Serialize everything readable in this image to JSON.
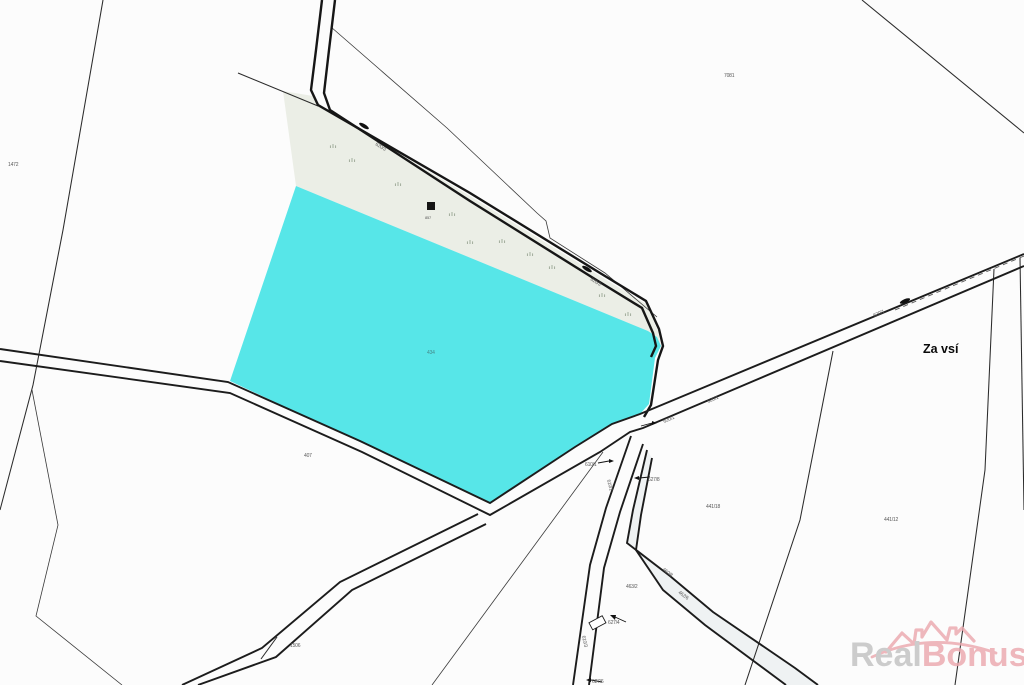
{
  "map": {
    "area_label": "Za vsí",
    "highlighted_parcel_number": "434",
    "building_number": "857",
    "colors": {
      "background": "#fcfcfc",
      "line": "#222222",
      "highlight": "#57E6E8",
      "strip": "#EBEEE6",
      "road_fill": "#EFF2F3",
      "label": "#5a5a5a",
      "grass": "#9AA694",
      "area_label_color": "#0a0a0a"
    },
    "labels": [
      {
        "text": "1472",
        "x": 8,
        "y": 166
      },
      {
        "text": "7081",
        "x": 724,
        "y": 77
      },
      {
        "text": "857",
        "x": 425,
        "y": 219,
        "size": 4
      },
      {
        "text": "434",
        "x": 427,
        "y": 354,
        "color": "#45888a"
      },
      {
        "text": "407",
        "x": 304,
        "y": 457
      },
      {
        "text": "620/3",
        "x": 375,
        "y": 145,
        "rot": 31
      },
      {
        "text": "620/3",
        "x": 590,
        "y": 280,
        "rot": 31
      },
      {
        "text": "620/1",
        "x": 664,
        "y": 423,
        "rot": -23
      },
      {
        "text": "620/1",
        "x": 708,
        "y": 403,
        "rot": -23
      },
      {
        "text": "620/1",
        "x": 874,
        "y": 317,
        "rot": -23
      },
      {
        "text": "610/1",
        "x": 585,
        "y": 466
      },
      {
        "text": "610/2",
        "x": 607,
        "y": 480,
        "rot": 75
      },
      {
        "text": "627/8",
        "x": 648,
        "y": 481
      },
      {
        "text": "441/18",
        "x": 706,
        "y": 508
      },
      {
        "text": "441/12",
        "x": 884,
        "y": 521
      },
      {
        "text": "1506",
        "x": 290,
        "y": 647
      },
      {
        "text": "463/2",
        "x": 626,
        "y": 588
      },
      {
        "text": "460/8",
        "x": 662,
        "y": 570,
        "rot": 37
      },
      {
        "text": "462/6",
        "x": 678,
        "y": 593,
        "rot": 37
      },
      {
        "text": "627/4",
        "x": 608,
        "y": 624
      },
      {
        "text": "610/3",
        "x": 582,
        "y": 636,
        "rot": 78
      },
      {
        "text": "627/6",
        "x": 592,
        "y": 683
      }
    ]
  },
  "watermark": {
    "part1": "Real",
    "part2": "Bonus",
    "suffix": ".cz",
    "part1_color": "#C2C2C2",
    "part2_color": "#EBA9AF",
    "suffix_color": "#D9B6B9",
    "logo": "realbonus-roofs-logo"
  }
}
